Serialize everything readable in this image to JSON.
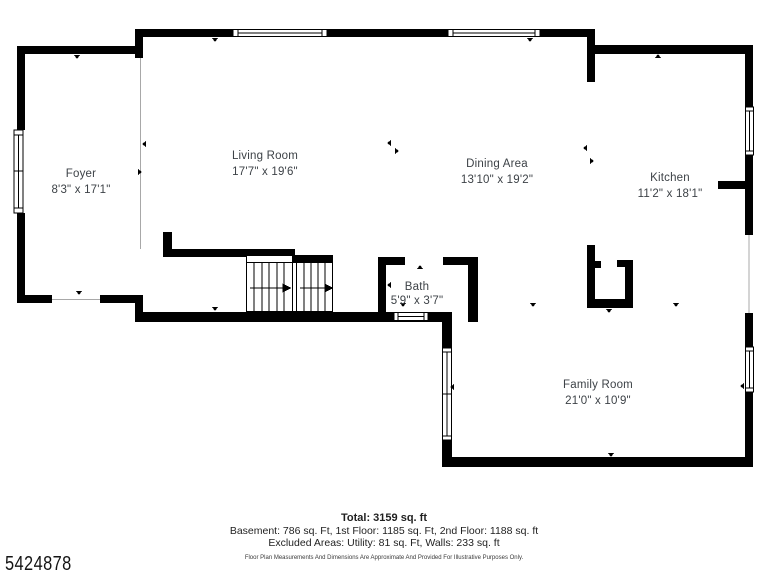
{
  "plan": {
    "rooms": [
      {
        "name": "Foyer",
        "dims": "8'3\" x 17'1\""
      },
      {
        "name": "Living Room",
        "dims": "17'7\" x 19'6\""
      },
      {
        "name": "Dining Area",
        "dims": "13'10\" x 19'2\""
      },
      {
        "name": "Kitchen",
        "dims": "11'2\" x 18'1\""
      },
      {
        "name": "Bath",
        "dims": "5'9\" x 3'7\""
      },
      {
        "name": "Family Room",
        "dims": "21'0\" x 10'9\""
      }
    ],
    "summary": {
      "total": "Total: 3159 sq. ft",
      "floors": "Basement: 786 sq. Ft, 1st Floor: 1185 sq. Ft, 2nd Floor: 1188 sq. ft",
      "excluded": "Excluded Areas: Utility: 81 sq. Ft, Walls: 233 sq. ft",
      "disclaimer": "Floor Plan Measurements And Dimensions Are Approximate And Provided For Illustrative Purposes Only."
    },
    "mls_number": "5424878",
    "colors": {
      "walls": "#000000",
      "label_text": "#3d4247",
      "background": "#ffffff"
    }
  }
}
